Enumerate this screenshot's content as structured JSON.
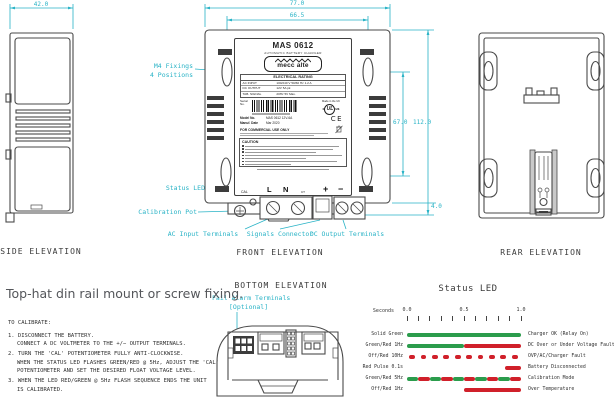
{
  "palette": {
    "accent": "#29b3c6",
    "line": "#4a4a4a",
    "green": "#2b9c4c",
    "red": "#d0202a"
  },
  "headline": "Top-hat din rail mount or screw fixing.",
  "views": {
    "side": {
      "title": "SIDE ELEVATION",
      "dim_width": "42.0"
    },
    "front": {
      "title": "FRONT ELEVATION",
      "dims": {
        "outer_width": "77.0",
        "fixing_width": "66.5",
        "fixing_height": "67.0",
        "overall_height": "112.0",
        "foot": "4.0"
      },
      "callouts": {
        "m4_line1": "M4 Fixings",
        "m4_line2": "4 Positions",
        "status_led": "Status LED",
        "calibration_pot": "Calibration Pot",
        "ac_input": "AC Input Terminals",
        "signals": "Signals Connector",
        "dc_output": "DC Output Terminals"
      }
    },
    "rear": {
      "title": "REAR ELEVATION"
    },
    "bottom": {
      "title": "BOTTOM ELEVATION",
      "callout_line1": "Fail Alarm Terminals",
      "callout_line2": "[Optional]"
    }
  },
  "label": {
    "model": "MAS 0612",
    "subtitle": "AUTOMATIC BATTERY CHARGER",
    "brand": "mecc alte",
    "rating_title": "ELECTRICAL RATING",
    "rating_rows": [
      [
        "AC INPUT",
        "100/240 V 50/60 Hz 1.2 A"
      ],
      [
        "DC OUTPUT",
        "12V 5A pk"
      ],
      [
        "TAB. SIGNAL",
        "20Hz 5V Max."
      ]
    ],
    "serial_label": "Serial No.",
    "made_in": "Made in the UK",
    "ul_prefix": "c",
    "ul_mark": "UL",
    "ul_suffix": "us",
    "ce_mark": "CE",
    "model_no_label": "Model No.",
    "model_no_value": "MAS 0612 12V-6A",
    "date_label": "Manuf. Date",
    "date_value": "Mar 2020",
    "commercial": "FOR COMMERCIAL USE ONLY",
    "caution": "CAUTION",
    "terminals": {
      "cal": "CAL",
      "l": "L",
      "n": "N",
      "ct": "CT",
      "plus": "+",
      "minus": "−"
    }
  },
  "calibration": {
    "title": "TO CALIBRATE:",
    "lines": [
      {
        "text": "1. DISCONNECT THE BATTERY.",
        "indent": false,
        "item": true
      },
      {
        "text": "CONNECT A DC VOLTMETER TO THE +/− OUTPUT TERMINALS.",
        "indent": true,
        "item": false
      },
      {
        "text": "2. TURN THE 'CAL' POTENTIOMETER FULLY ANTI-CLOCKWISE.",
        "indent": false,
        "item": true
      },
      {
        "text": "WHEN THE STATUS LED FLASHES GREEN/RED @ 5Hz, ADJUST THE 'CAL'",
        "indent": true,
        "item": false
      },
      {
        "text": "POTENTIOMETER AND SET THE DESIRED FLOAT VOLTAGE LEVEL.",
        "indent": true,
        "item": false
      },
      {
        "text": "3. WHEN THE LED RED/GREEN @ 5Hz FLASH SEQUENCE ENDS THE UNIT",
        "indent": false,
        "item": true
      },
      {
        "text": "IS CALIBRATED.",
        "indent": true,
        "item": false
      }
    ]
  },
  "status_led": {
    "title": "Status LED",
    "axis": {
      "label": "Seconds",
      "tick_labels": [
        "0.0",
        "0.5",
        "1.0"
      ],
      "minor_ticks": 11,
      "range": [
        0,
        1
      ]
    },
    "rows": [
      {
        "pattern": "Solid Green",
        "meaning": "Charger OK (Relay On)",
        "segments": [
          [
            "g",
            0,
            1
          ]
        ]
      },
      {
        "pattern": "Green/Red 1Hz",
        "meaning": "DC Over or Under Voltage Fault",
        "segments": [
          [
            "g",
            0,
            0.5
          ],
          [
            "r",
            0.5,
            1
          ]
        ]
      },
      {
        "pattern": "Off/Red 10Hz",
        "meaning": "OVP/AC/Charger Fault",
        "segments": [
          [
            "r",
            0.02,
            0.07
          ],
          [
            "r",
            0.12,
            0.17
          ],
          [
            "r",
            0.22,
            0.27
          ],
          [
            "r",
            0.32,
            0.37
          ],
          [
            "r",
            0.42,
            0.47
          ],
          [
            "r",
            0.52,
            0.57
          ],
          [
            "r",
            0.62,
            0.67
          ],
          [
            "r",
            0.72,
            0.77
          ],
          [
            "r",
            0.82,
            0.87
          ],
          [
            "r",
            0.92,
            0.97
          ]
        ]
      },
      {
        "pattern": "Red Pulse 0.1s",
        "meaning": "Battery Disconnected",
        "segments": [
          [
            "r",
            0.86,
            1
          ]
        ]
      },
      {
        "pattern": "Green/Red 5Hz",
        "meaning": "Calibration Mode",
        "segments": [
          [
            "g",
            0,
            0.1
          ],
          [
            "r",
            0.1,
            0.2
          ],
          [
            "g",
            0.2,
            0.3
          ],
          [
            "r",
            0.3,
            0.4
          ],
          [
            "g",
            0.4,
            0.5
          ],
          [
            "r",
            0.5,
            0.6
          ],
          [
            "g",
            0.6,
            0.7
          ],
          [
            "r",
            0.7,
            0.8
          ],
          [
            "g",
            0.8,
            0.9
          ],
          [
            "r",
            0.9,
            1
          ]
        ]
      },
      {
        "pattern": "Off/Red 1Hz",
        "meaning": "Over Temperature",
        "segments": [
          [
            "r",
            0.5,
            1
          ]
        ]
      }
    ]
  }
}
